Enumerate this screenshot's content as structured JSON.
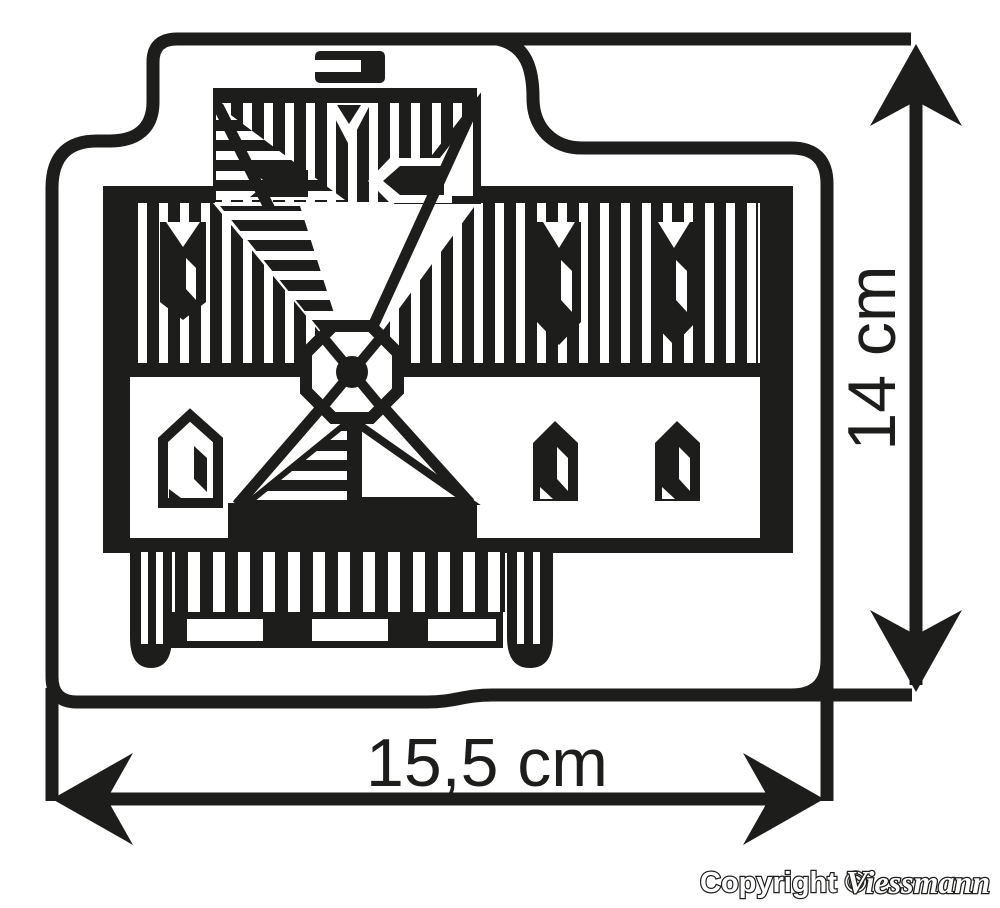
{
  "diagram": {
    "subject": "windmill-building-footprint-top-view",
    "width_label": "15,5 cm",
    "height_label": "14 cm"
  },
  "footer": {
    "copyright_prefix": "Copyright ©",
    "brand": "Viessmann"
  },
  "colors": {
    "ink": "#1d1d1b",
    "background": "#ffffff"
  }
}
